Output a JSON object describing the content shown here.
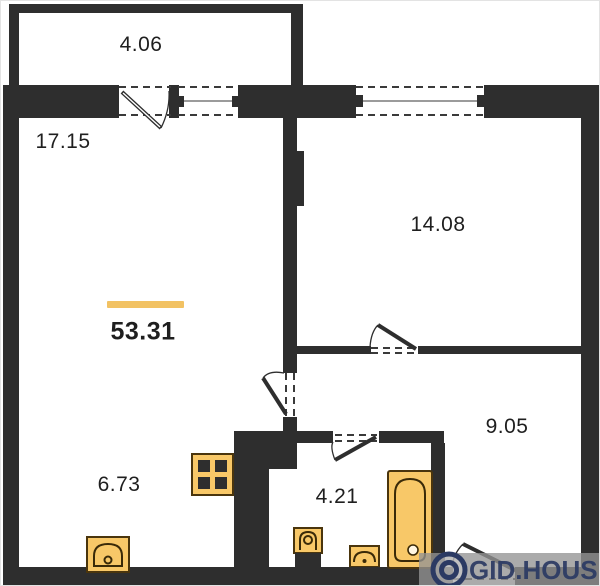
{
  "plan": {
    "total": {
      "area": "53.31"
    },
    "rooms": [
      {
        "name": "balcony",
        "area": "4.06"
      },
      {
        "name": "living-room",
        "area": "17.15"
      },
      {
        "name": "bedroom",
        "area": "14.08"
      },
      {
        "name": "hallway",
        "area": "9.05"
      },
      {
        "name": "kitchen",
        "area": "6.73"
      },
      {
        "name": "bathroom",
        "area": "4.21"
      }
    ],
    "fixtures": [
      {
        "name": "stove-icon"
      },
      {
        "name": "kitchen-sink-icon"
      },
      {
        "name": "toilet-icon"
      },
      {
        "name": "washbasin-icon"
      },
      {
        "name": "bathtub-icon"
      }
    ],
    "colors": {
      "wall": "#2e2e2e",
      "accent_bar": "#f2c263",
      "fixture_fill": "#f8c868",
      "fixture_outline": "#4a350d",
      "watermark_navy": "#2b3a63",
      "watermark_band": "#949494"
    }
  },
  "watermark": {
    "text": "GID.HOUSE"
  }
}
